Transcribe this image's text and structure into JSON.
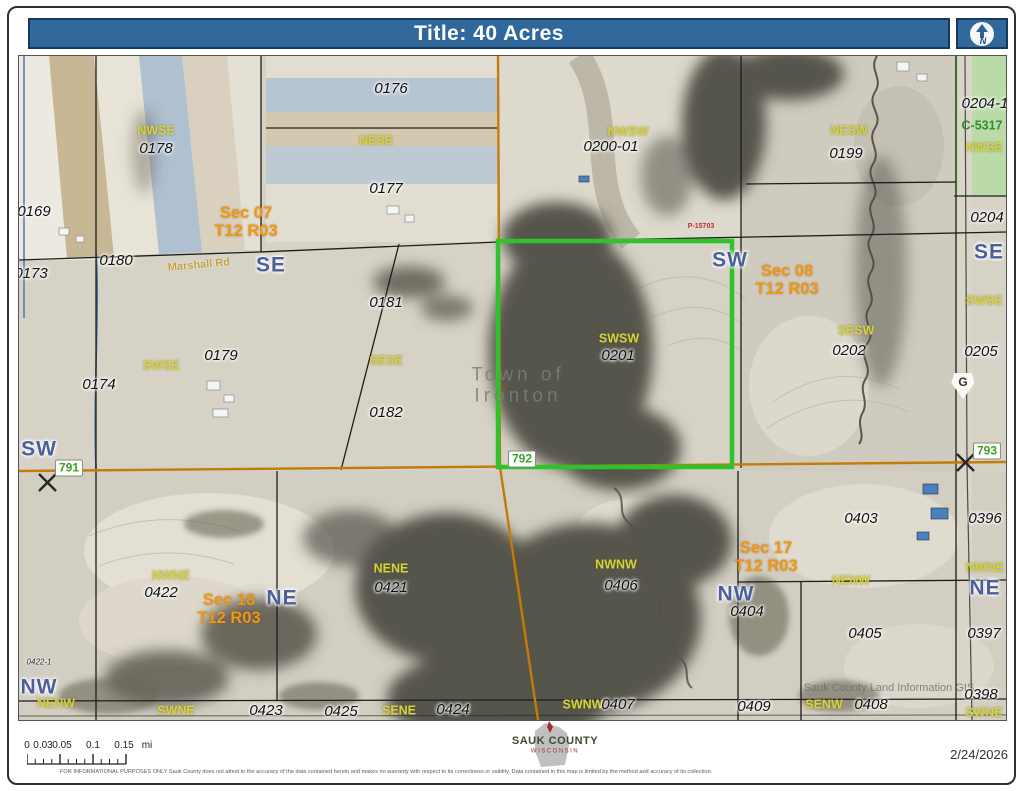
{
  "header": {
    "title": "Title: 40 Acres",
    "north_label": "N"
  },
  "icons": {
    "north_arrow": "north-arrow-icon",
    "wisconsin_shape": "wisconsin-state-icon",
    "scale_ruler": "scale-ruler-icon",
    "survey_marker": "survey-x-icon"
  },
  "colors": {
    "header_blue": "#30689b",
    "parcel_highlight_green": "#2ec32b",
    "section_orange": "#ec9715",
    "qq_yellow": "#d6d23c",
    "quarter_blue": "#4c5f9c",
    "highway_green": "#3f9e2d",
    "road_orange": "#c47b08"
  },
  "map": {
    "labels": [
      {
        "type": "qq",
        "text": "NWSE",
        "x": 137,
        "y": 75
      },
      {
        "type": "qq",
        "text": "NESE",
        "x": 357,
        "y": 85
      },
      {
        "type": "qq",
        "text": "NWSW",
        "x": 609,
        "y": 76
      },
      {
        "type": "qq",
        "text": "NESW",
        "x": 830,
        "y": 75
      },
      {
        "type": "qq",
        "text": "NWSE",
        "x": 965,
        "y": 92
      },
      {
        "type": "qq",
        "text": "SWSE",
        "x": 142,
        "y": 310
      },
      {
        "type": "qq",
        "text": "SESE",
        "x": 367,
        "y": 305
      },
      {
        "type": "qq",
        "text": "SWSW",
        "x": 600,
        "y": 283
      },
      {
        "type": "qq",
        "text": "SESW",
        "x": 837,
        "y": 275
      },
      {
        "type": "qq",
        "text": "SWSE",
        "x": 965,
        "y": 245
      },
      {
        "type": "qq",
        "text": "NWNE",
        "x": 152,
        "y": 520
      },
      {
        "type": "qq",
        "text": "NENE",
        "x": 372,
        "y": 513
      },
      {
        "type": "qq",
        "text": "NWNW",
        "x": 597,
        "y": 509
      },
      {
        "type": "qq",
        "text": "NENW",
        "x": 832,
        "y": 525
      },
      {
        "type": "qq",
        "text": "NWNE",
        "x": 966,
        "y": 512
      },
      {
        "type": "qq",
        "text": "NENW",
        "x": 37,
        "y": 648
      },
      {
        "type": "qq",
        "text": "SWNE",
        "x": 157,
        "y": 655
      },
      {
        "type": "qq",
        "text": "SENE",
        "x": 380,
        "y": 655
      },
      {
        "type": "qq",
        "text": "SWNW",
        "x": 564,
        "y": 649
      },
      {
        "type": "qq",
        "text": "SENW",
        "x": 805,
        "y": 649
      },
      {
        "type": "qq",
        "text": "SWNE",
        "x": 965,
        "y": 657
      },
      {
        "type": "parcel",
        "text": "0178",
        "x": 137,
        "y": 93
      },
      {
        "type": "parcel",
        "text": "0176",
        "x": 372,
        "y": 33
      },
      {
        "type": "parcel",
        "text": "0177",
        "x": 367,
        "y": 133
      },
      {
        "type": "parcel",
        "text": "0200-01",
        "x": 592,
        "y": 91
      },
      {
        "type": "parcel",
        "text": "0199",
        "x": 827,
        "y": 98
      },
      {
        "type": "parcel",
        "text": "0204-1",
        "x": 966,
        "y": 48
      },
      {
        "type": "parcel",
        "text": "0169",
        "x": 15,
        "y": 156
      },
      {
        "type": "parcel",
        "text": "0173",
        "x": 12,
        "y": 218
      },
      {
        "type": "parcel",
        "text": "0180",
        "x": 97,
        "y": 205
      },
      {
        "type": "parcel",
        "text": "0181",
        "x": 367,
        "y": 247
      },
      {
        "type": "parcel",
        "text": "0174",
        "x": 80,
        "y": 329
      },
      {
        "type": "parcel",
        "text": "0179",
        "x": 202,
        "y": 300
      },
      {
        "type": "parcel",
        "text": "0182",
        "x": 367,
        "y": 357
      },
      {
        "type": "parcel",
        "text": "0201",
        "x": 599,
        "y": 300
      },
      {
        "type": "parcel",
        "text": "0202",
        "x": 830,
        "y": 295
      },
      {
        "type": "parcel",
        "text": "0204",
        "x": 968,
        "y": 162
      },
      {
        "type": "parcel",
        "text": "0205",
        "x": 962,
        "y": 296
      },
      {
        "type": "parcel",
        "text": "0422",
        "x": 142,
        "y": 537
      },
      {
        "type": "parcel",
        "text": "0421",
        "x": 372,
        "y": 532
      },
      {
        "type": "parcel",
        "text": "0406",
        "x": 602,
        "y": 530
      },
      {
        "type": "parcel",
        "text": "0403",
        "x": 842,
        "y": 463
      },
      {
        "type": "parcel",
        "text": "0396",
        "x": 966,
        "y": 463
      },
      {
        "type": "parcel",
        "text": "0404",
        "x": 728,
        "y": 556
      },
      {
        "type": "parcel",
        "text": "0405",
        "x": 846,
        "y": 578
      },
      {
        "type": "parcel",
        "text": "0397",
        "x": 965,
        "y": 578
      },
      {
        "type": "parcel",
        "text": "0423",
        "x": 247,
        "y": 655
      },
      {
        "type": "parcel",
        "text": "0425",
        "x": 322,
        "y": 656
      },
      {
        "type": "parcel",
        "text": "0424",
        "x": 434,
        "y": 654
      },
      {
        "type": "parcel",
        "text": "0407",
        "x": 599,
        "y": 649
      },
      {
        "type": "parcel",
        "text": "0409",
        "x": 735,
        "y": 651
      },
      {
        "type": "parcel",
        "text": "0408",
        "x": 852,
        "y": 649
      },
      {
        "type": "parcel",
        "text": "0398",
        "x": 962,
        "y": 639
      },
      {
        "type": "parcel-sm",
        "text": "0422-1",
        "x": 20,
        "y": 607
      },
      {
        "type": "quarter",
        "text": "SE",
        "x": 252,
        "y": 210
      },
      {
        "type": "quarter",
        "text": "SW",
        "x": 711,
        "y": 205
      },
      {
        "type": "quarter",
        "text": "SE",
        "x": 970,
        "y": 197
      },
      {
        "type": "quarter",
        "text": "SW",
        "x": 20,
        "y": 394
      },
      {
        "type": "quarter",
        "text": "NE",
        "x": 263,
        "y": 543
      },
      {
        "type": "quarter",
        "text": "NW",
        "x": 717,
        "y": 539
      },
      {
        "type": "quarter",
        "text": "NE",
        "x": 966,
        "y": 533
      },
      {
        "type": "quarter",
        "text": "NW",
        "x": 20,
        "y": 632
      },
      {
        "type": "section",
        "text": "Sec 07",
        "text2": "T12 R03",
        "x": 227,
        "y": 167
      },
      {
        "type": "section",
        "text": "Sec 08",
        "text2": "T12 R03",
        "x": 768,
        "y": 225
      },
      {
        "type": "section",
        "text": "Sec 18",
        "text2": "T12 R03",
        "x": 210,
        "y": 554
      },
      {
        "type": "section",
        "text": "Sec 17",
        "text2": "T12 R03",
        "x": 747,
        "y": 502
      },
      {
        "type": "road",
        "text": "Marshall Rd",
        "x": 180,
        "y": 210
      },
      {
        "type": "red",
        "text": "P-15703",
        "x": 682,
        "y": 171
      },
      {
        "type": "greenid",
        "text": "C-5317",
        "x": 963,
        "y": 70
      },
      {
        "type": "town",
        "text": "Town of",
        "text2": "Ironton",
        "x": 499,
        "y": 330
      },
      {
        "type": "gis",
        "text": "Sauk County Land Information GIS",
        "x": 870,
        "y": 633
      }
    ],
    "badges": [
      {
        "type": "hwy",
        "text": "791",
        "x": 50,
        "y": 412
      },
      {
        "type": "hwy",
        "text": "792",
        "x": 503,
        "y": 403
      },
      {
        "type": "hwy",
        "text": "793",
        "x": 968,
        "y": 395
      },
      {
        "type": "g",
        "text": "G",
        "x": 944,
        "y": 330
      }
    ]
  },
  "footer": {
    "scalebar": {
      "labels": [
        {
          "t": "0",
          "x": 0
        },
        {
          "t": "0.03",
          "x": 16
        },
        {
          "t": "0.05",
          "x": 35
        },
        {
          "t": "0.1",
          "x": 66
        },
        {
          "t": "0.15",
          "x": 97
        },
        {
          "t": "mi",
          "x": 120
        }
      ]
    },
    "logo": {
      "name": "SAUK COUNTY",
      "state": "WISCONSIN"
    },
    "date": "2/24/2026",
    "disclaimer": "FOR INFORMATIONAL PURPOSES ONLY Sauk County does not attest to the accuracy of the data contained herein and makes no warranty with respect to its correctness or validity. Data contained in this map is limited by the method and accuracy of its collection."
  }
}
